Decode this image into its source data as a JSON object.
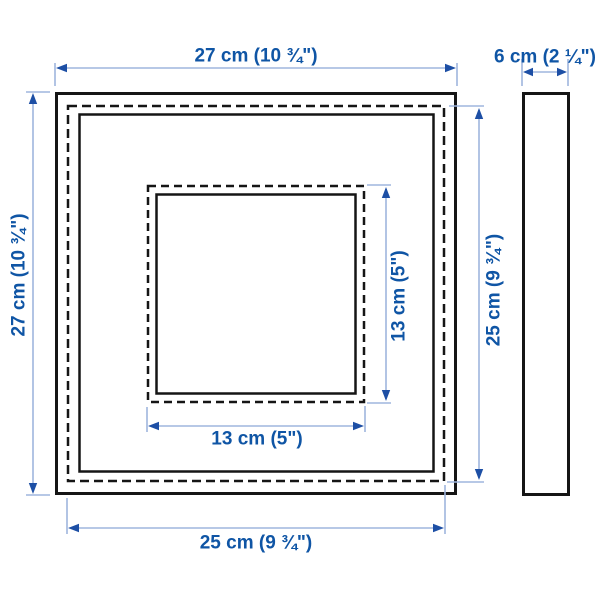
{
  "colors": {
    "dimension_text": "#0f55a5",
    "dimension_line": "#9fb5dd",
    "arrow": "#1d4fa5",
    "frame_outline": "#151515",
    "background": "#ffffff"
  },
  "labels": {
    "front_width": "27 cm (10 ¾\")",
    "front_height": "27 cm (10 ¾\")",
    "side_depth": "6 cm (2 ¼\")",
    "back_width": "25 cm (9 ¾\")",
    "back_height": "25 cm (9 ¾\")",
    "opening_width": "13 cm (5\")",
    "opening_height": "13 cm (5\")"
  }
}
